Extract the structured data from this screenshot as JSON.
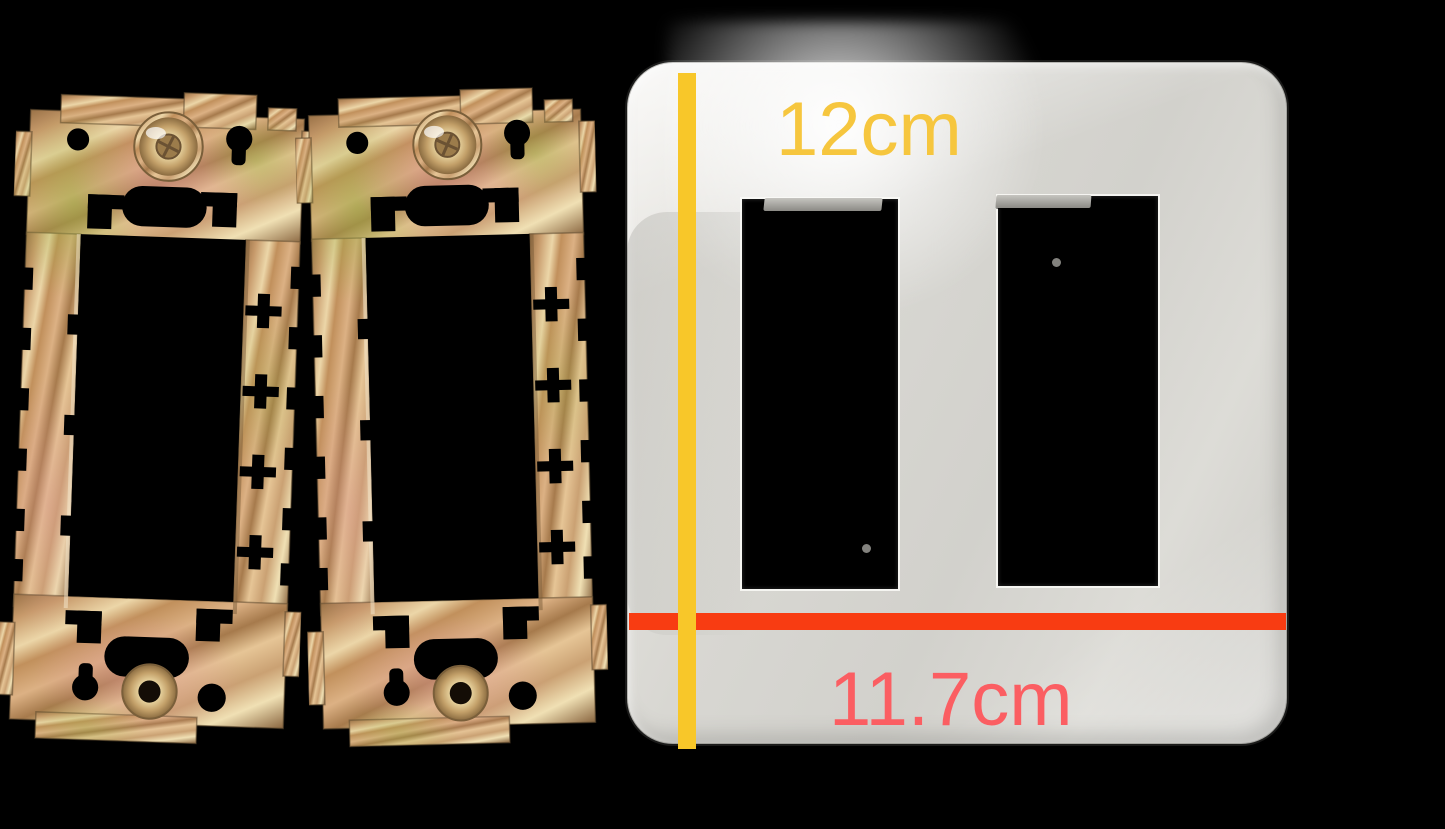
{
  "scene": {
    "description": "Product photo: two brass wall-plate mounting brackets beside a white two-gang decorator wall plate with dimension annotations",
    "background_color": "#000000"
  },
  "measurements": {
    "height": {
      "label": "12cm",
      "orientation": "vertical",
      "text_color": "#F6C63E",
      "line_color": "#F8C729"
    },
    "width": {
      "label": "11.7cm",
      "orientation": "horizontal",
      "text_color": "#FB5E62",
      "line_color": "#F83C12"
    }
  },
  "objects": {
    "bracket_left": {
      "label": "brass mounting bracket",
      "color": "#C89B6E"
    },
    "bracket_right": {
      "label": "brass mounting bracket",
      "color": "#C89B6E"
    },
    "wall_plate": {
      "label": "white 2-gang wall plate",
      "color": "#D8D7D2",
      "opening_count": 2
    }
  }
}
